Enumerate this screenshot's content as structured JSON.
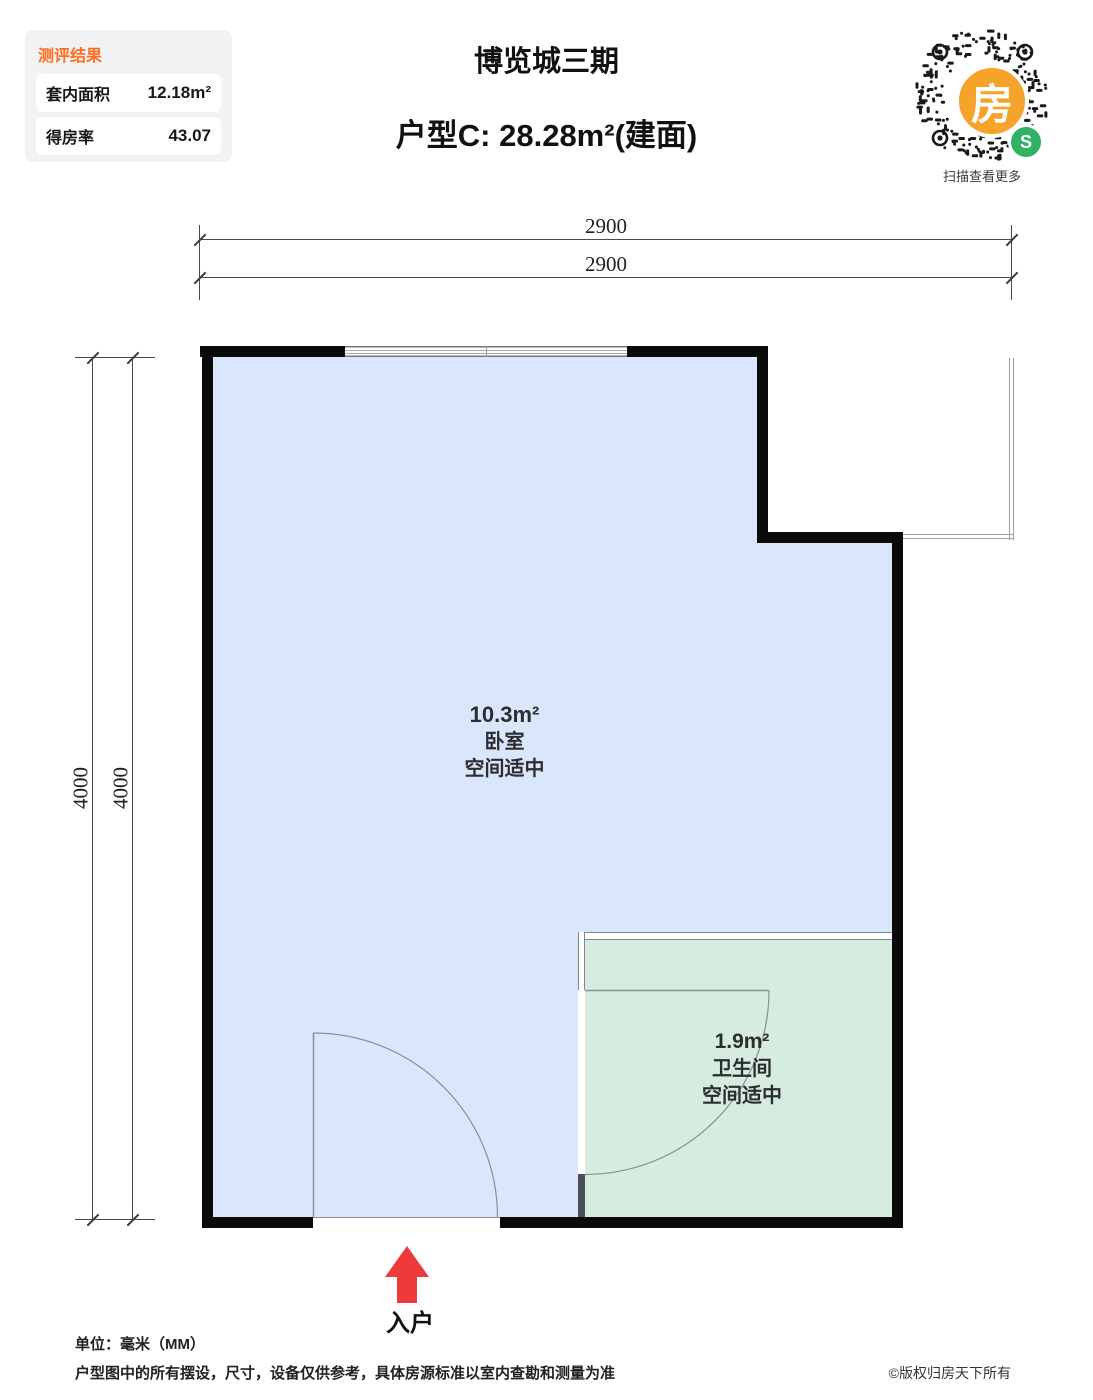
{
  "evaluation_card": {
    "title": "测评结果",
    "rows": [
      {
        "label": "套内面积",
        "value": "12.18m²"
      },
      {
        "label": "得房率",
        "value": "43.07"
      }
    ]
  },
  "header": {
    "project_name": "博览城三期",
    "unit_title": "户型C: 28.28m²(建面)"
  },
  "qr": {
    "center_char": "房",
    "badge": "S",
    "caption": "扫描查看更多"
  },
  "dimensions": {
    "unit": "mm",
    "top": [
      "2900",
      "2900"
    ],
    "left": [
      "4000",
      "4000"
    ]
  },
  "rooms": [
    {
      "name": "卧室",
      "area": "10.3m²",
      "note": "空间适中",
      "fill": "#d9e6fc"
    },
    {
      "name": "卫生间",
      "area": "1.9m²",
      "note": "空间适中",
      "fill": "#d5ecdf"
    }
  ],
  "entry": {
    "label": "入户",
    "arrow_color": "#ee3a3a"
  },
  "footer": {
    "unit_note": "单位：毫米（MM）",
    "disclaimer": "户型图中的所有摆设，尺寸，设备仅供参考，具体房源标准以室内查勘和测量为准",
    "copyright": "©版权归房天下所有"
  },
  "colors": {
    "accent_orange": "#ff6d1f",
    "qr_orange": "#f5a32a",
    "wechat_green": "#2fb264",
    "arrow_red": "#ee3a3a",
    "wall_black": "#0a0a0a",
    "bedroom_fill": "#d9e6fc",
    "bathroom_fill": "#d5ecdf"
  }
}
